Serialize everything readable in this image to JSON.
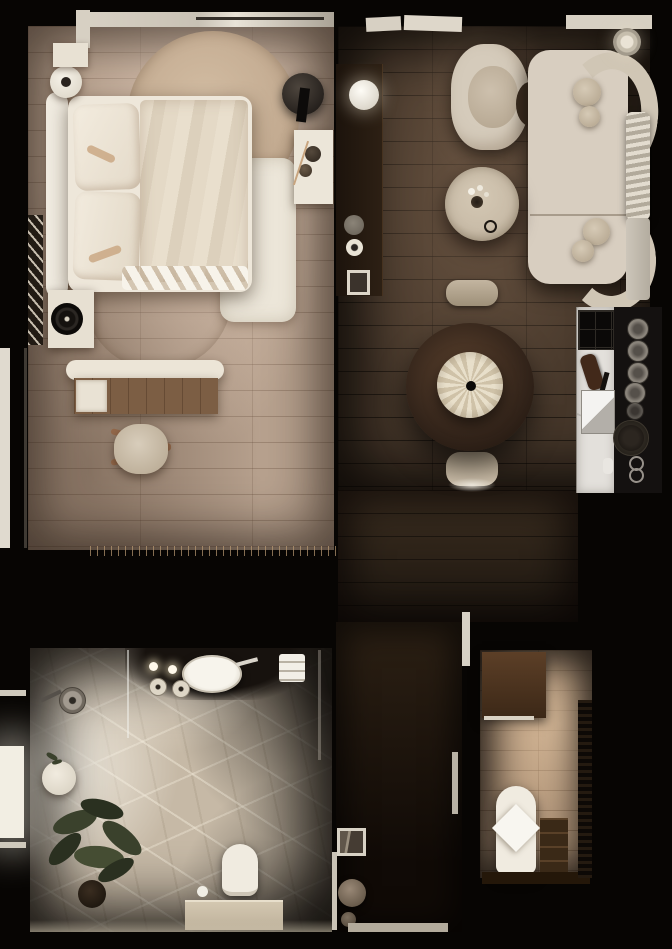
{
  "scene": {
    "type": "apartment-floor-plan-3d-render",
    "view": "top-down",
    "rooms": [
      {
        "id": "bedroom",
        "name": "bedroom",
        "items": [
          "bed",
          "headboard",
          "pillows",
          "blanket",
          "knit-throw",
          "round-rug-large",
          "round-rug-small",
          "white-runner-rug",
          "bedside-round-table",
          "bedside-ledge",
          "dark-round-nightstand",
          "black-vase",
          "white-wall-console",
          "teapot",
          "jar",
          "wall-ladder-rack",
          "white-cabinet",
          "record-player-speaker",
          "desk",
          "desk-drawer-unit",
          "wood-chair",
          "rug-fringe",
          "window-sill",
          "curtain-rod",
          "entry-door"
        ]
      },
      {
        "id": "living-dining",
        "name": "living-dining-room",
        "items": [
          "media-console",
          "sphere-lamp",
          "decor-bowl",
          "cup",
          "photo-frame",
          "armchair",
          "l-shaped-sofa",
          "bolster-cushions",
          "floor-lamp",
          "radiator-bench-with-throw",
          "travertine-coffee-table",
          "flower-vase",
          "decor-rings",
          "round-dining-table",
          "pendant-lamp",
          "dining-chair-north",
          "dining-chair-south",
          "window-sills"
        ]
      },
      {
        "id": "kitchen",
        "name": "galley-kitchen",
        "items": [
          "marble-counter",
          "dark-counter-strip",
          "window-grid",
          "cutting-board",
          "faucet",
          "square-sink",
          "plate-stack",
          "cooktop",
          "soap-dish",
          "glasses"
        ]
      },
      {
        "id": "hallway",
        "name": "entry-hall",
        "items": [
          "photo-frame",
          "pouf",
          "decor-ball",
          "threshold",
          "wall-slivers"
        ]
      },
      {
        "id": "utility",
        "name": "utility-laundry-room",
        "items": [
          "wood-cabinet",
          "ironing-board",
          "cloth",
          "shelf-unit",
          "counter",
          "louver-vent"
        ]
      },
      {
        "id": "bathroom",
        "name": "bathroom",
        "items": [
          "stone-floor",
          "vanity",
          "oval-vessel-sink",
          "faucet",
          "candles",
          "round-trays",
          "towel-stack",
          "shower-glass",
          "rain-shower-head",
          "side-table",
          "plant-sprigs",
          "large-potted-plant",
          "toilet",
          "stone-bench",
          "cup",
          "window-light"
        ]
      }
    ]
  },
  "colors": {
    "bg": "#070503",
    "sill": "#d7d0c3",
    "cream": "#d8cec0",
    "white": "#f0ebe0",
    "whiteSoft": "#ece6d9",
    "bedFloor": "#b7a18e",
    "rugTan": "#c3ab91",
    "rugTanDeep": "#bca députés",
    "livMid": "#46372a",
    "hallTop": "#2c2014",
    "hallBottom": "#100a06",
    "bathBase": "#c6b9a6",
    "utilMid": "#b3977b",
    "deskWood": "#7c5e44",
    "travertine": "#c9bca8",
    "tanAccent": "#c8a47e",
    "plant": "#3a412c",
    "plantDark": "#2a3020",
    "glow": "#fff4dc"
  }
}
